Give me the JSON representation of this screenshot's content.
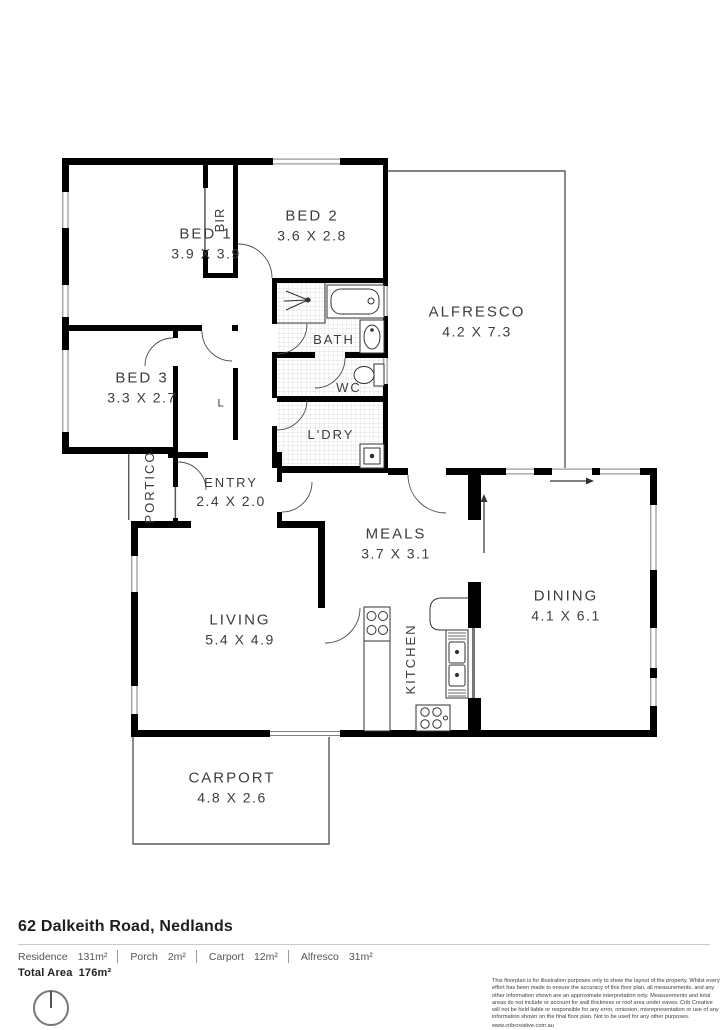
{
  "plan": {
    "rooms": {
      "bed1": {
        "name": "BED 1",
        "dims": "3.9 X 3.9"
      },
      "bed2": {
        "name": "BED 2",
        "dims": "3.6 X 2.8"
      },
      "bed3": {
        "name": "BED 3",
        "dims": "3.3 X 2.7"
      },
      "bir": {
        "name": "BIR"
      },
      "linen": {
        "name": "L"
      },
      "bath": {
        "name": "BATH"
      },
      "wc": {
        "name": "WC"
      },
      "laundry": {
        "name": "L'DRY"
      },
      "portico": {
        "name": "PORTICO"
      },
      "entry": {
        "name": "ENTRY",
        "dims": "2.4 X 2.0"
      },
      "alfresco": {
        "name": "ALFRESCO",
        "dims": "4.2 X 7.3"
      },
      "meals": {
        "name": "MEALS",
        "dims": "3.7 X 3.1"
      },
      "living": {
        "name": "LIVING",
        "dims": "5.4 X 4.9"
      },
      "kitchen": {
        "name": "KITCHEN"
      },
      "dining": {
        "name": "DINING",
        "dims": "4.1 X 6.1"
      },
      "carport": {
        "name": "CARPORT",
        "dims": "4.8 X 2.6"
      }
    },
    "colors": {
      "wall": "#000000",
      "thin_outline": "#555555",
      "label": "#3d3d3d"
    }
  },
  "footer": {
    "address": "62 Dalkeith Road, Nedlands",
    "areas": [
      {
        "label": "Residence",
        "value": "131m²"
      },
      {
        "label": "Porch",
        "value": "2m²"
      },
      {
        "label": "Carport",
        "value": "12m²"
      },
      {
        "label": "Alfresco",
        "value": "31m²"
      }
    ],
    "total_label": "Total Area",
    "total_value": "176m²",
    "compass_icon": "north-compass",
    "disclaimer": "This floorplan is for illustration purposes only to show the layout of the property. Whilst every effort has been made to ensure the accuracy of this floor plan, all measurements, and any other information shown are an approximate interpretation only. Measurements and total areas do not include or account for wall thickness or roof area under eaves. Crib Creative will not be held liable or responsible for any error, omission, misrepresentation or use of any information shown on the final floor plan. Not to be used for any other purposes.",
    "website": "www.cribcreative.com.au"
  }
}
